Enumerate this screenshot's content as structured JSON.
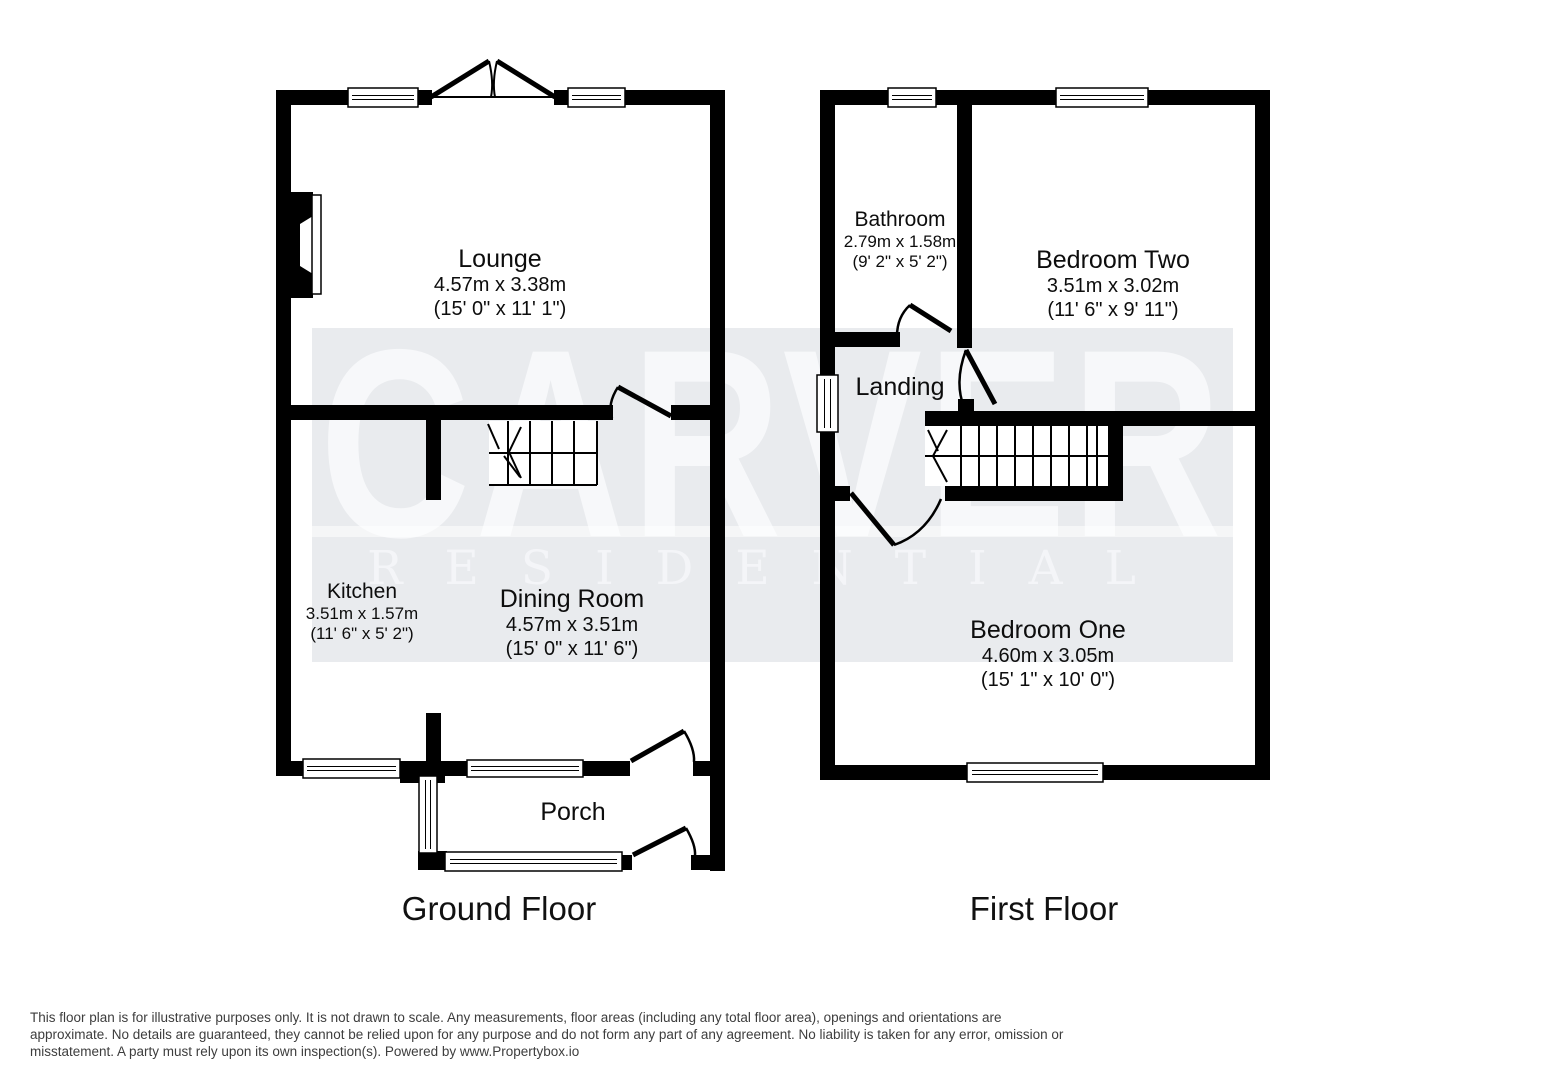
{
  "watermark": {
    "title": "CARVER",
    "subtitle": "RESIDENTIAL"
  },
  "floors": [
    {
      "title": "Ground Floor",
      "rooms": [
        {
          "name": "Lounge",
          "metric": "4.57m x 3.38m",
          "imperial": "(15' 0\" x 11' 1\")"
        },
        {
          "name": "Kitchen",
          "metric": "3.51m x 1.57m",
          "imperial": "(11' 6\" x 5' 2\")"
        },
        {
          "name": "Dining Room",
          "metric": "4.57m x 3.51m",
          "imperial": "(15' 0\" x 11' 6\")"
        },
        {
          "name": "Porch"
        }
      ]
    },
    {
      "title": "First Floor",
      "rooms": [
        {
          "name": "Bathroom",
          "metric": "2.79m x 1.58m",
          "imperial": "(9' 2\" x 5' 2\")"
        },
        {
          "name": "Bedroom Two",
          "metric": "3.51m x 3.02m",
          "imperial": "(11' 6\" x 9' 11\")"
        },
        {
          "name": "Landing"
        },
        {
          "name": "Bedroom One",
          "metric": "4.60m x 3.05m",
          "imperial": "(15' 1\" x 10' 0\")"
        }
      ]
    }
  ],
  "disclaimer": {
    "lines": [
      "This floor plan is for illustrative purposes only. It is not drawn to scale. Any measurements, floor areas (including any total floor area), openings and orientations are",
      "approximate. No details are guaranteed, they cannot be relied upon for any purpose and do not form any part of any agreement. No liability is taken for any error, omission or",
      "misstatement. A party must rely upon its own inspection(s). Powered by www.Propertybox.io"
    ]
  },
  "colors": {
    "wall": "#000000",
    "watermark_band": "#e9ebee",
    "watermark_text": "#f7f8fa"
  }
}
